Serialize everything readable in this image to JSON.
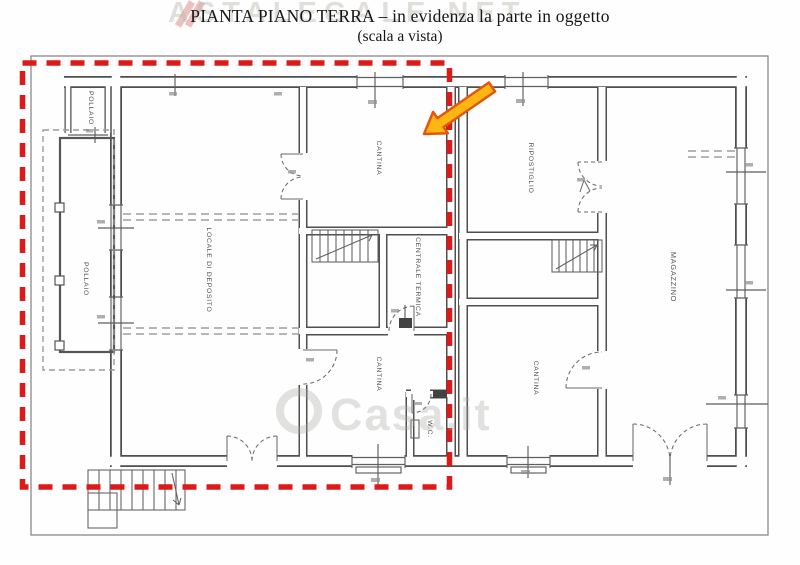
{
  "title": {
    "line1": "PIANTA PIANO TERRA – in evidenza la parte in oggetto",
    "line2": "(scala a vista)"
  },
  "watermarks": {
    "top": "ASTALEGALE.NET",
    "center": "Casa.it"
  },
  "rooms": {
    "pollaio_top": "POLLAIO",
    "pollaio_left": "POLLAIO",
    "locale_deposito": "LOCALE DI DEPOSITO",
    "cantina_top": "CANTINA",
    "centrale_termica": "CENTRALE TERMICA",
    "cantina_mid": "CANTINA",
    "wc": "W.C.",
    "ripostiglio": "RIPOSTIGLIO",
    "cantina_right": "CANTINA",
    "magazzino": "MAGAZZINO"
  },
  "colors": {
    "highlight_red": "#dd1a1a",
    "arrow_fill": "#ffb612",
    "arrow_stroke": "#e2570f",
    "wall": "#4f4f4f"
  }
}
